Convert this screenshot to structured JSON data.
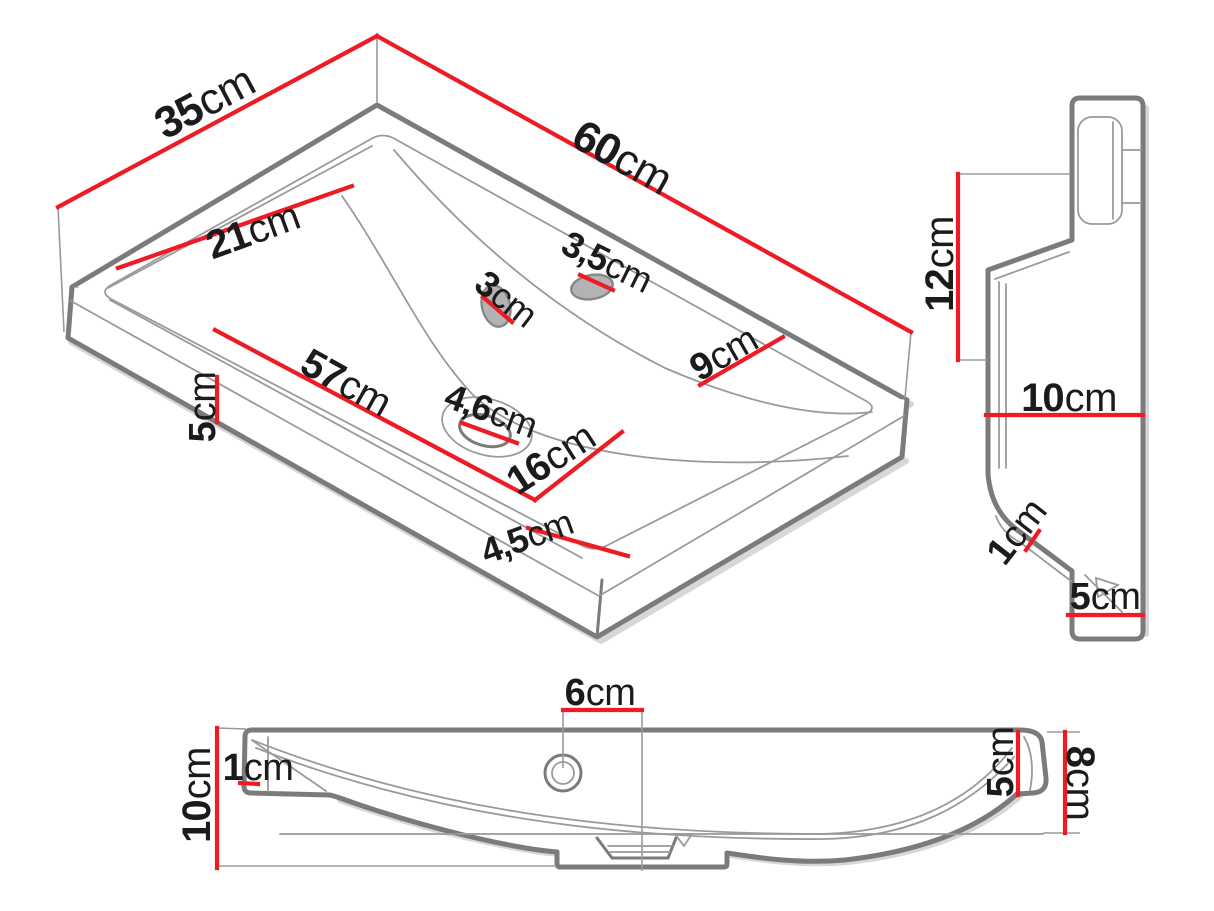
{
  "colors": {
    "dimension": "#ed1c24",
    "outline": "#7b7b7b",
    "detail": "#9a9a9a",
    "label": "#1b1b1b",
    "background": "#ffffff"
  },
  "views": {
    "isometric": {
      "dims": {
        "top_width": {
          "value": "35",
          "unit": "cm"
        },
        "top_length": {
          "value": "60",
          "unit": "cm"
        },
        "basin_width": {
          "value": "21",
          "unit": "cm"
        },
        "overflow_hole": {
          "value": "3",
          "unit": "cm"
        },
        "tap_hole": {
          "value": "3,5",
          "unit": "cm"
        },
        "deck_depth": {
          "value": "9",
          "unit": "cm"
        },
        "basin_length": {
          "value": "57",
          "unit": "cm"
        },
        "front_edge_height": {
          "value": "5",
          "unit": "cm"
        },
        "drain_hole": {
          "value": "4,6",
          "unit": "cm"
        },
        "drain_offset": {
          "value": "16",
          "unit": "cm"
        },
        "front_rim_width": {
          "value": "4,5",
          "unit": "cm"
        }
      }
    },
    "side": {
      "dims": {
        "back_height": {
          "value": "12",
          "unit": "cm"
        },
        "depth": {
          "value": "10",
          "unit": "cm"
        },
        "lip_thickness": {
          "value": "1",
          "unit": "cm"
        },
        "base_depth": {
          "value": "5",
          "unit": "cm"
        }
      }
    },
    "front": {
      "dims": {
        "tap_hole_offset": {
          "value": "6",
          "unit": "cm"
        },
        "left_lip": {
          "value": "1",
          "unit": "cm"
        },
        "total_height": {
          "value": "10",
          "unit": "cm"
        },
        "inner_right_height": {
          "value": "5",
          "unit": "cm"
        },
        "right_height": {
          "value": "8",
          "unit": "cm"
        }
      }
    }
  }
}
